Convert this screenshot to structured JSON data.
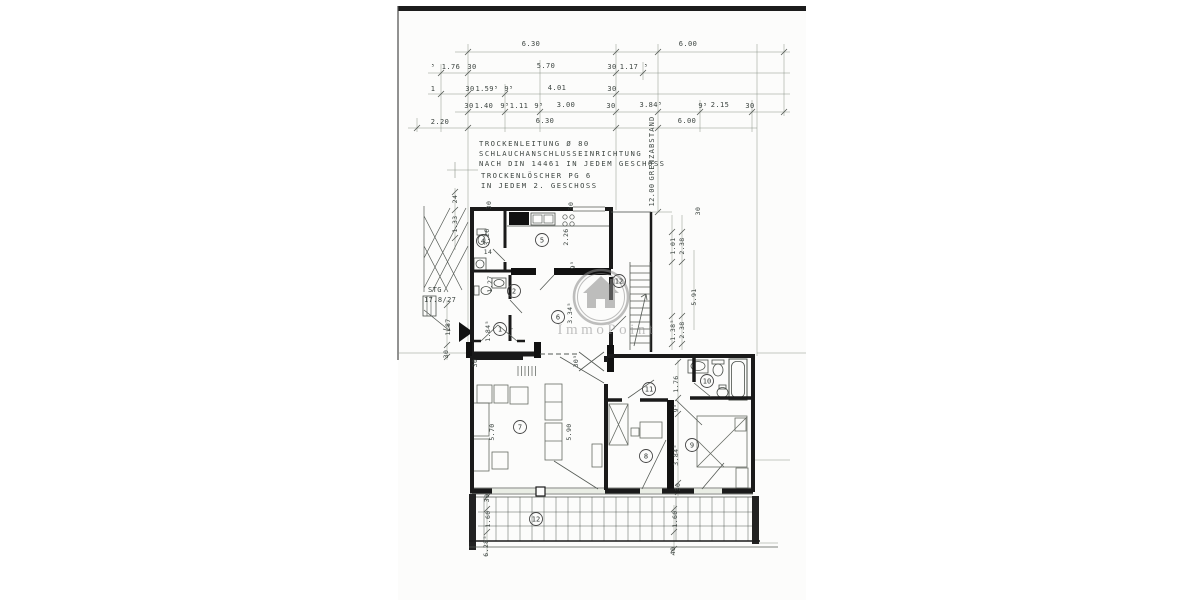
{
  "watermark": {
    "brand": "ImmoPoint",
    "icon": "house-icon"
  },
  "colors": {
    "paper": "#fcfcfb",
    "scan_bar": "#1c1c1c",
    "wall": "#1a1a1a",
    "dimension_line": "#8a9288",
    "annotation_text": "#3c4440",
    "window_tint": "#e9ede4",
    "watermark_gray": "#8f8f8f"
  },
  "annotations": [
    {
      "t": "6.30",
      "x": 531,
      "y": 46
    },
    {
      "t": "6.00",
      "x": 688,
      "y": 46
    },
    {
      "t": "⁵",
      "x": 433,
      "y": 69
    },
    {
      "t": "1.76",
      "x": 451,
      "y": 69
    },
    {
      "t": "30",
      "x": 472,
      "y": 69
    },
    {
      "t": "5.70",
      "x": 546,
      "y": 68
    },
    {
      "t": "30",
      "x": 612,
      "y": 69
    },
    {
      "t": "1.17",
      "x": 629,
      "y": 69
    },
    {
      "t": "⁵",
      "x": 646,
      "y": 69
    },
    {
      "t": "1",
      "x": 433,
      "y": 91
    },
    {
      "t": "30",
      "x": 470,
      "y": 91
    },
    {
      "t": "1.59⁵",
      "x": 487,
      "y": 91
    },
    {
      "t": "9⁵",
      "x": 509,
      "y": 91
    },
    {
      "t": "4.01",
      "x": 557,
      "y": 90
    },
    {
      "t": "30",
      "x": 612,
      "y": 91
    },
    {
      "t": "30",
      "x": 469,
      "y": 108
    },
    {
      "t": "1.40",
      "x": 484,
      "y": 108
    },
    {
      "t": "9⁵",
      "x": 505,
      "y": 108
    },
    {
      "t": "1.11",
      "x": 519,
      "y": 108
    },
    {
      "t": "9⁵",
      "x": 539,
      "y": 108
    },
    {
      "t": "3.00",
      "x": 566,
      "y": 107
    },
    {
      "t": "30",
      "x": 611,
      "y": 108
    },
    {
      "t": "3.84⁵",
      "x": 651,
      "y": 107
    },
    {
      "t": "9⁵",
      "x": 703,
      "y": 108
    },
    {
      "t": "2.15",
      "x": 720,
      "y": 107
    },
    {
      "t": "30",
      "x": 750,
      "y": 108
    },
    {
      "t": "2.20",
      "x": 440,
      "y": 124
    },
    {
      "t": "6.30",
      "x": 545,
      "y": 123
    },
    {
      "t": "6.00",
      "x": 687,
      "y": 123
    },
    {
      "t": "GRENZABSTAND",
      "x": 654,
      "y": 148,
      "r": -90,
      "ls": 1.2
    },
    {
      "t": "12.00",
      "x": 654,
      "y": 195,
      "r": -90
    },
    {
      "t": "24",
      "x": 457,
      "y": 199,
      "r": -90,
      "s": 6.5
    },
    {
      "t": "1.33",
      "x": 457,
      "y": 224,
      "r": -90,
      "s": 6.5
    },
    {
      "t": "30",
      "x": 491,
      "y": 205,
      "r": -90,
      "s": 6.5
    },
    {
      "t": "30",
      "x": 573,
      "y": 206,
      "r": -90,
      "s": 6.5
    },
    {
      "t": "3.26",
      "x": 489,
      "y": 237,
      "r": -90,
      "s": 6.5
    },
    {
      "t": "2.26",
      "x": 568,
      "y": 237,
      "r": -90,
      "s": 6.5
    },
    {
      "t": "9⁵",
      "x": 575,
      "y": 265,
      "r": -90,
      "s": 6.5
    },
    {
      "t": "1.27",
      "x": 492,
      "y": 284,
      "r": -90,
      "s": 6.5
    },
    {
      "t": "1.84⁵",
      "x": 490,
      "y": 331,
      "r": -90,
      "s": 6.5
    },
    {
      "t": "3.34⁵",
      "x": 572,
      "y": 313,
      "r": -90,
      "s": 6.5
    },
    {
      "t": "1.87",
      "x": 450,
      "y": 327,
      "r": -90,
      "s": 6.5
    },
    {
      "t": "30",
      "x": 448,
      "y": 354,
      "r": -90,
      "s": 6.5
    },
    {
      "t": "30",
      "x": 477,
      "y": 363,
      "r": -90,
      "s": 6.5
    },
    {
      "t": "30⁵",
      "x": 578,
      "y": 361,
      "r": -90,
      "s": 6.5
    },
    {
      "t": "1.01",
      "x": 675,
      "y": 246,
      "r": -90,
      "s": 6.5
    },
    {
      "t": "2.38",
      "x": 684,
      "y": 246,
      "r": -90,
      "s": 6.5
    },
    {
      "t": "5.91",
      "x": 696,
      "y": 297,
      "r": -90,
      "s": 6.5
    },
    {
      "t": "1.38⁵",
      "x": 675,
      "y": 330,
      "r": -90,
      "s": 6.5
    },
    {
      "t": "2.38",
      "x": 684,
      "y": 330,
      "r": -90,
      "s": 6.5
    },
    {
      "t": "30",
      "x": 700,
      "y": 211,
      "r": -90,
      "s": 6.5
    },
    {
      "t": "1.76",
      "x": 678,
      "y": 384,
      "r": -90,
      "s": 6.5
    },
    {
      "t": "9⁵",
      "x": 678,
      "y": 408,
      "r": -90,
      "s": 6.5
    },
    {
      "t": "3.84⁵",
      "x": 678,
      "y": 455,
      "r": -90,
      "s": 6.5
    },
    {
      "t": "30",
      "x": 680,
      "y": 487,
      "r": -90,
      "s": 6.5
    },
    {
      "t": "5.70",
      "x": 494,
      "y": 432,
      "r": -90,
      "s": 6.5
    },
    {
      "t": "5.90",
      "x": 571,
      "y": 432,
      "r": -90,
      "s": 6.5
    },
    {
      "t": "30",
      "x": 489,
      "y": 498,
      "r": -90,
      "s": 6.5
    },
    {
      "t": "1.60",
      "x": 490,
      "y": 519,
      "r": -90,
      "s": 6.5
    },
    {
      "t": "1.60",
      "x": 677,
      "y": 519,
      "r": -90,
      "s": 6.5
    },
    {
      "t": "6.28⁵",
      "x": 488,
      "y": 546,
      "r": -90,
      "s": 6.5
    },
    {
      "t": "40",
      "x": 675,
      "y": 551,
      "r": -90,
      "s": 6.5
    },
    {
      "t": "TROCKENLEITUNG Ø 80",
      "x": 479,
      "y": 146,
      "a": "s",
      "s": 7.2,
      "ls": 1.5,
      "n": "note-line-1"
    },
    {
      "t": "SCHLAUCHANSCHLUSSEINRICHTUNG",
      "x": 479,
      "y": 156,
      "a": "s",
      "s": 7.2,
      "ls": 1.5,
      "n": "note-line-2"
    },
    {
      "t": "NACH DIN 14461 IN JEDEM GESCHOSS",
      "x": 479,
      "y": 166,
      "a": "s",
      "s": 7.2,
      "ls": 1.5,
      "n": "note-line-3"
    },
    {
      "t": "TROCKENLÖSCHER PG 6",
      "x": 481,
      "y": 178,
      "a": "s",
      "s": 7.2,
      "ls": 1.5,
      "n": "note-line-4"
    },
    {
      "t": "IN JEDEM 2. GESCHOSS",
      "x": 481,
      "y": 188,
      "a": "s",
      "s": 7.2,
      "ls": 1.5,
      "n": "note-line-5"
    },
    {
      "t": "STG",
      "x": 428,
      "y": 292,
      "a": "s",
      "s": 7,
      "n": "stair-spec-label"
    },
    {
      "t": "17.8/27",
      "x": 424,
      "y": 302,
      "a": "s",
      "s": 7,
      "n": "stair-spec-value"
    },
    {
      "t": "14",
      "x": 488,
      "y": 254,
      "s": 6.5
    },
    {
      "t": "-",
      "x": 512,
      "y": 331,
      "s": 7
    }
  ],
  "rooms": [
    {
      "n": "1",
      "x": 500,
      "y": 329
    },
    {
      "n": "2",
      "x": 514,
      "y": 291
    },
    {
      "n": "4",
      "x": 483,
      "y": 241
    },
    {
      "n": "5",
      "x": 542,
      "y": 240
    },
    {
      "n": "6",
      "x": 558,
      "y": 317
    },
    {
      "n": "7",
      "x": 520,
      "y": 427
    },
    {
      "n": "8",
      "x": 646,
      "y": 456
    },
    {
      "n": "9",
      "x": 692,
      "y": 445
    },
    {
      "n": "10",
      "x": 707,
      "y": 381
    },
    {
      "n": "11",
      "x": 649,
      "y": 389
    },
    {
      "n": "12",
      "x": 619,
      "y": 281
    },
    {
      "n": "12",
      "x": 536,
      "y": 519
    }
  ]
}
